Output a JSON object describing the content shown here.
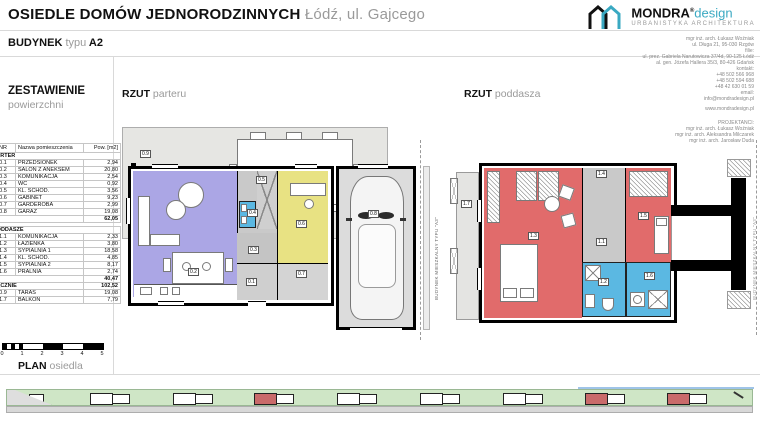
{
  "colors": {
    "accent": "#3aa9c2",
    "salon": "#aba6e5",
    "office": "#e8e283",
    "bath": "#5bb8e2",
    "bedroom": "#e16b6b",
    "stairs": "#c9c9c9",
    "terrace": "#e6e6e3",
    "grass": "#cfe6c6",
    "road": "#d8d8d8",
    "bldgred": "#c96a6a"
  },
  "header": {
    "title_bold": "OSIEDLE DOMÓW JEDNORODZINNYCH",
    "title_light": "Łódź, ul. Gajcego",
    "building_bold": "BUDYNEK",
    "building_light": "typu",
    "building_type": "A2"
  },
  "logo": {
    "name": "MONDRA",
    "reg": "®",
    "design": "design",
    "subtitle": "URBANISTYKA  ARCHITEKTURA"
  },
  "contact": {
    "lines": [
      "mgr inż. arch. Łukasz Woźniak",
      "ul. Długa 21, 95-030 Rzgów",
      "filie:",
      "ul. prez. Gabriela Narutowicza 37/4d, 90-125 Łódź",
      "al. gen. Józefa Hallera 35/3, 80-426 Gdańsk",
      "kontakt:",
      "+48 502 566 968",
      "+48 502 594 688",
      "+48 42 630 01 59",
      "email:",
      "info@mondradesign.pl"
    ],
    "website": "www.mondradesign.pl",
    "designers_heading": "PROJEKTANCI:",
    "designers": [
      "mgr inż. arch. Łukasz Woźniak",
      "mgr inż. arch. Aleksandra Milczarek",
      "mgr inż. arch. Jarosław Duda"
    ]
  },
  "summary": {
    "title": "ZESTAWIENIE",
    "subtitle": "powierzchni",
    "col_nr": "NR",
    "col_name": "Nazwa pomieszczenia",
    "col_area": "Pow. [m2]",
    "parter_label": "PARTER",
    "parter_rows": [
      {
        "nr": "0.1",
        "name": "PRZEDSIONEK",
        "area": "2,94"
      },
      {
        "nr": "0.2",
        "name": "SALON Z ANEKSEM",
        "area": "20,80"
      },
      {
        "nr": "0.3",
        "name": "KOMUNIKACJA",
        "area": "2,54"
      },
      {
        "nr": "0.4",
        "name": "WC",
        "area": "0,92"
      },
      {
        "nr": "0.5",
        "name": "KL. SCHOD.",
        "area": "3,56"
      },
      {
        "nr": "0.6",
        "name": "GABINET",
        "area": "9,23"
      },
      {
        "nr": "0.7",
        "name": "GARDEROBA",
        "area": "2,99"
      },
      {
        "nr": "0.8",
        "name": "GARAŻ",
        "area": "19,08"
      }
    ],
    "parter_total": "62,05",
    "poddasze_label": "PODDASZE",
    "poddasze_rows": [
      {
        "nr": "1.1",
        "name": "KOMUNIKACJA",
        "area": "2,33"
      },
      {
        "nr": "1.2",
        "name": "ŁAZIENKA",
        "area": "3,80"
      },
      {
        "nr": "1.3",
        "name": "SYPIALNIA 1",
        "area": "18,58"
      },
      {
        "nr": "1.4",
        "name": "KL. SCHOD.",
        "area": "4,85"
      },
      {
        "nr": "1.5",
        "name": "SYPIALNIA 2",
        "area": "8,17"
      },
      {
        "nr": "1.6",
        "name": "PRALNIA",
        "area": "2,74"
      }
    ],
    "poddasze_total": "40,47",
    "total_label": "ŁĄCZNIE",
    "total": "102,52",
    "extra_rows": [
      {
        "nr": "0.9",
        "name": "TARAS",
        "area": "19,08"
      },
      {
        "nr": "1.7",
        "name": "BALKON",
        "area": "7,79"
      }
    ]
  },
  "parter": {
    "title": "RZUT",
    "subtitle": "parteru",
    "rooms": {
      "r01": "0.1",
      "r02": "0.2",
      "r03": "0.3",
      "r04": "0.4",
      "r05": "0.5",
      "r06": "0.6",
      "r07": "0.7",
      "r08": "0.8",
      "r09": "0.9"
    }
  },
  "poddasze": {
    "title": "RZUT",
    "subtitle": "poddasza",
    "rooms": {
      "r11": "1.1",
      "r12": "1.2",
      "r13": "1.3",
      "r14": "1.4",
      "r15": "1.5",
      "r16": "1.6",
      "r17": "1.7"
    }
  },
  "side_note": "BUDYNEK MIESZKALNY TYPU \"A3\"",
  "scalebar": {
    "ticks": [
      "0",
      "1",
      "2",
      "3",
      "4",
      "5"
    ]
  },
  "siteplan": {
    "label_bold": "PLAN",
    "label_light": "osiedla",
    "buildings": [
      {
        "x": 22,
        "red": false,
        "single": true
      },
      {
        "x": 83,
        "red": false
      },
      {
        "x": 166,
        "red": false
      },
      {
        "x": 247,
        "red": true
      },
      {
        "x": 330,
        "red": false
      },
      {
        "x": 413,
        "red": false
      },
      {
        "x": 496,
        "red": false
      },
      {
        "x": 578,
        "red": true
      },
      {
        "x": 660,
        "red": true
      }
    ]
  }
}
